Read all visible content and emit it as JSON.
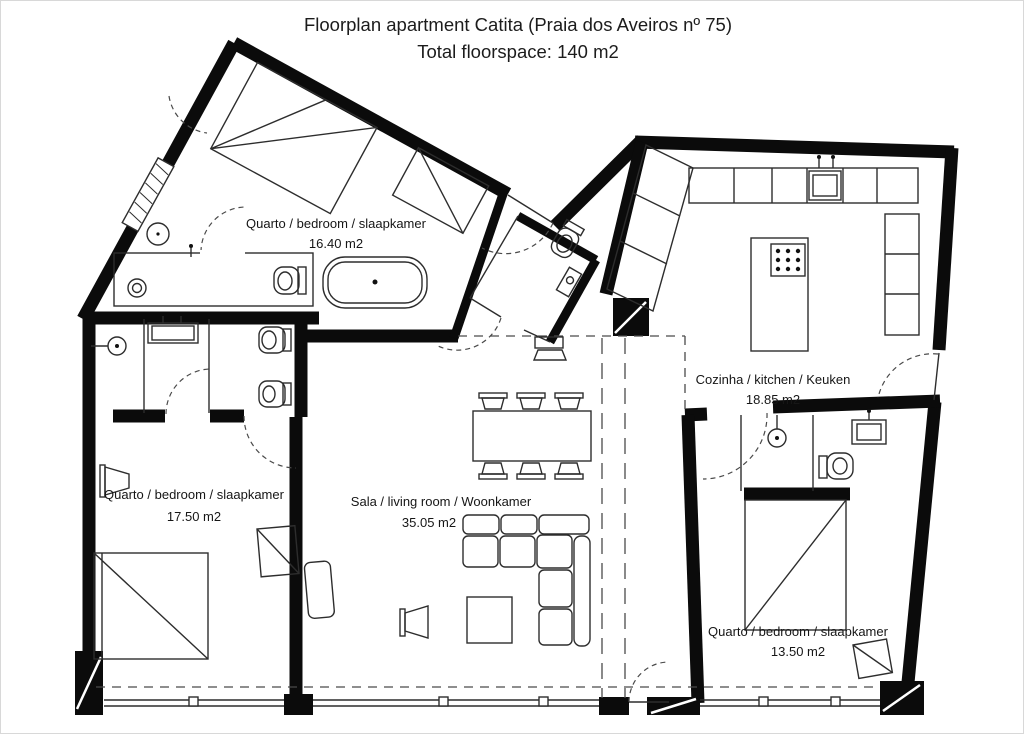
{
  "title": "Floorplan apartment Catita (Praia dos Aveiros nº 75)",
  "subtitle": "Total floorspace: 140 m2",
  "rooms": [
    {
      "id": "bedroom-top",
      "label": "Quarto / bedroom / slaapkamer",
      "area": "16.40 m2"
    },
    {
      "id": "kitchen",
      "label": "Cozinha / kitchen / Keuken",
      "area": "18.85 m2"
    },
    {
      "id": "living-room",
      "label": "Sala / living room / Woonkamer",
      "area": "35.05 m2"
    },
    {
      "id": "bedroom-left",
      "label": "Quarto / bedroom / slaapkamer",
      "area": "17.50 m2"
    },
    {
      "id": "bedroom-right",
      "label": "Quarto / bedroom / slaapkamer",
      "area": "13.50 m2"
    }
  ],
  "colors": {
    "walls": "#0b0b0b",
    "lines": "#2d2d2d",
    "dashed": "#4a4a4a",
    "background": "#ffffff"
  }
}
